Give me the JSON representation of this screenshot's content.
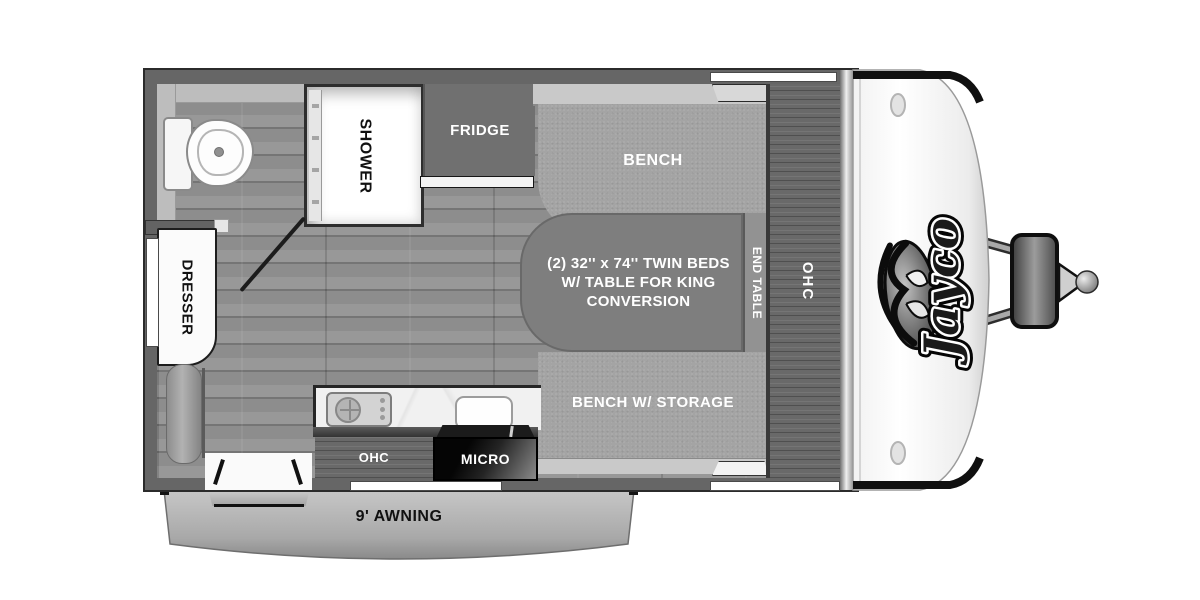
{
  "title": "Jayco travel trailer floorplan",
  "brand": {
    "logo_text": "Jayco"
  },
  "labels": {
    "shower": "SHOWER",
    "fridge": "FRIDGE",
    "bench": "BENCH",
    "twin_beds": [
      "(2) 32'' x 74'' TWIN BEDS",
      "W/ TABLE FOR KING",
      "CONVERSION"
    ],
    "end_table": "END TABLE",
    "ohc_overhead": "OHC",
    "bench_storage": "BENCH W/ STORAGE",
    "ohc_kitchen": "OHC",
    "micro": "MICRO",
    "dresser": "DRESSER",
    "awning": "9' AWNING"
  },
  "colors": {
    "wall": "#666666",
    "floor": "#919191",
    "cabinet_wood": "#696969",
    "bench_fabric": "#a4a4a4",
    "table": "#7e7e7e",
    "counter": "#f1f1f1",
    "micro_box": "#111111",
    "awning": "#b5b5b5",
    "front_cap": "#ffffff",
    "label_light": "#ffffff",
    "label_dark": "#111111"
  }
}
